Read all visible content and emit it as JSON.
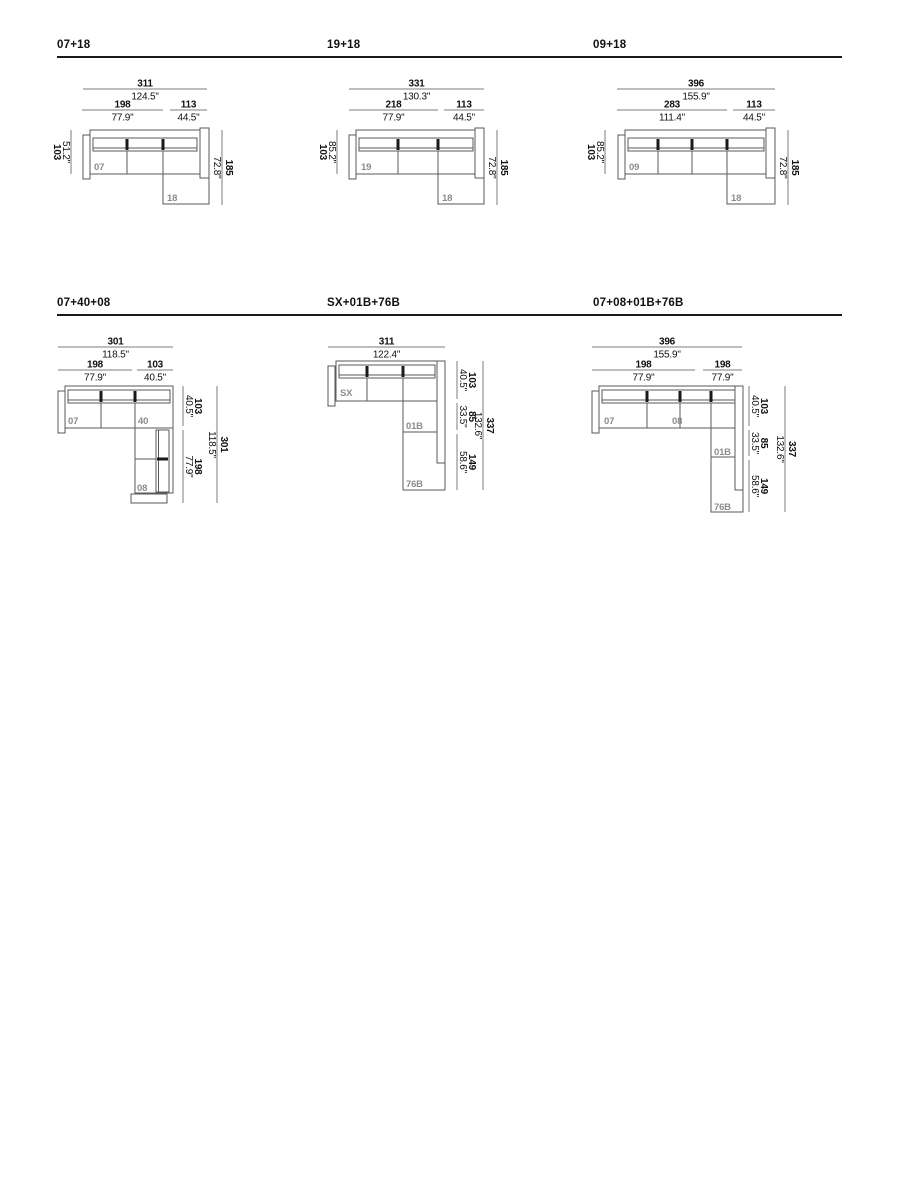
{
  "page": {
    "background": "#ffffff",
    "dim_line_color": "#7d7d7d",
    "outline_color": "#5a5a5a",
    "cushion_mark_color": "#1a1a1a",
    "text_color": "#111111",
    "module_label_color": "#8c8c8c"
  },
  "diagrams": [
    {
      "title": "07+18",
      "top_overall": {
        "cm": "311",
        "in": "124.5\""
      },
      "top_subs": [
        {
          "cm": "198",
          "in": "77.9\""
        },
        {
          "cm": "113",
          "in": "44.5\""
        }
      ],
      "left_dim": {
        "cm": "103",
        "in": "51.2\""
      },
      "right_dims": [],
      "right_overall": {
        "cm": "185",
        "in": "72.8\""
      },
      "module_labels": [
        "07",
        "18"
      ]
    },
    {
      "title": "19+18",
      "top_overall": {
        "cm": "331",
        "in": "130.3\""
      },
      "top_subs": [
        {
          "cm": "218",
          "in": "77.9\""
        },
        {
          "cm": "113",
          "in": "44.5\""
        }
      ],
      "left_dim": {
        "cm": "103",
        "in": "85.2\""
      },
      "right_dims": [],
      "right_overall": {
        "cm": "185",
        "in": "72.8\""
      },
      "module_labels": [
        "19",
        "18"
      ]
    },
    {
      "title": "09+18",
      "top_overall": {
        "cm": "396",
        "in": "155.9\""
      },
      "top_subs": [
        {
          "cm": "283",
          "in": "111.4\""
        },
        {
          "cm": "113",
          "in": "44.5\""
        }
      ],
      "left_dim": {
        "cm": "103",
        "in": "85.2\""
      },
      "right_dims": [],
      "right_overall": {
        "cm": "185",
        "in": "72.8\""
      },
      "module_labels": [
        "09",
        "18"
      ]
    },
    {
      "title": "07+40+08",
      "top_overall": {
        "cm": "301",
        "in": "118.5\""
      },
      "top_subs": [
        {
          "cm": "198",
          "in": "77.9\""
        },
        {
          "cm": "103",
          "in": "40.5\""
        }
      ],
      "left_dim": null,
      "right_dims": [
        {
          "cm": "103",
          "in": "40.5\""
        },
        {
          "cm": "198",
          "in": "77.9\""
        }
      ],
      "right_overall": {
        "cm": "301",
        "in": "118.5\""
      },
      "module_labels": [
        "07",
        "40",
        "08"
      ]
    },
    {
      "title": "SX+01B+76B",
      "top_overall": {
        "cm": "311",
        "in": "122.4\""
      },
      "top_subs": [],
      "left_dim": null,
      "right_dims": [
        {
          "cm": "103",
          "in": "40.5\""
        },
        {
          "cm": "85",
          "in": "33.5\""
        },
        {
          "cm": "149",
          "in": "58.6\""
        }
      ],
      "right_overall": {
        "cm": "337",
        "in": "132.6\""
      },
      "module_labels": [
        "SX",
        "01B",
        "76B"
      ]
    },
    {
      "title": "07+08+01B+76B",
      "top_overall": {
        "cm": "396",
        "in": "155.9\""
      },
      "top_subs": [
        {
          "cm": "198",
          "in": "77.9\""
        },
        {
          "cm": "198",
          "in": "77.9\""
        }
      ],
      "left_dim": null,
      "right_dims": [
        {
          "cm": "103",
          "in": "40.5\""
        },
        {
          "cm": "85",
          "in": "33.5\""
        },
        {
          "cm": "149",
          "in": "58.6\""
        }
      ],
      "right_overall": {
        "cm": "337",
        "in": "132.6\""
      },
      "module_labels": [
        "07",
        "08",
        "01B",
        "76B"
      ]
    }
  ]
}
